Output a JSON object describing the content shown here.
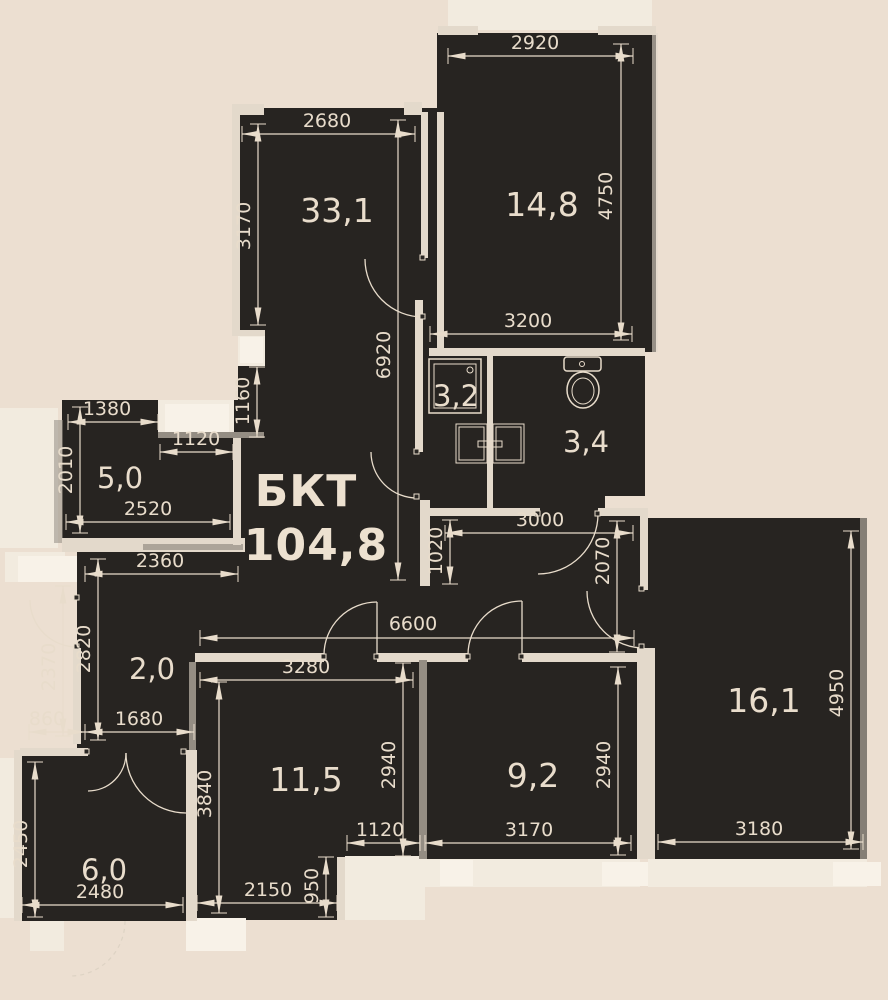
{
  "plan": {
    "title": "БКТ",
    "total_area": "104,8",
    "rooms": [
      "33,1",
      "14,8",
      "3,2",
      "3,4",
      "5,0",
      "2,0",
      "11,5",
      "9,2",
      "16,1",
      "6,0"
    ],
    "dims": [
      "2920",
      "4750",
      "2680",
      "3170",
      "3200",
      "6920",
      "1160",
      "1380",
      "1120",
      "2010",
      "2520",
      "2360",
      "1020",
      "3000",
      "2070",
      "6600",
      "3280",
      "2820",
      "2370",
      "860",
      "1680",
      "3840",
      "2940",
      "2940",
      "4950",
      "1120",
      "3170",
      "3180",
      "950",
      "2150",
      "2450",
      "2480"
    ]
  },
  "colors": {
    "background": "#ecdfd1",
    "floor": "#272421",
    "wall_light": "#e3d9cb",
    "lines": "#e8dccb"
  }
}
